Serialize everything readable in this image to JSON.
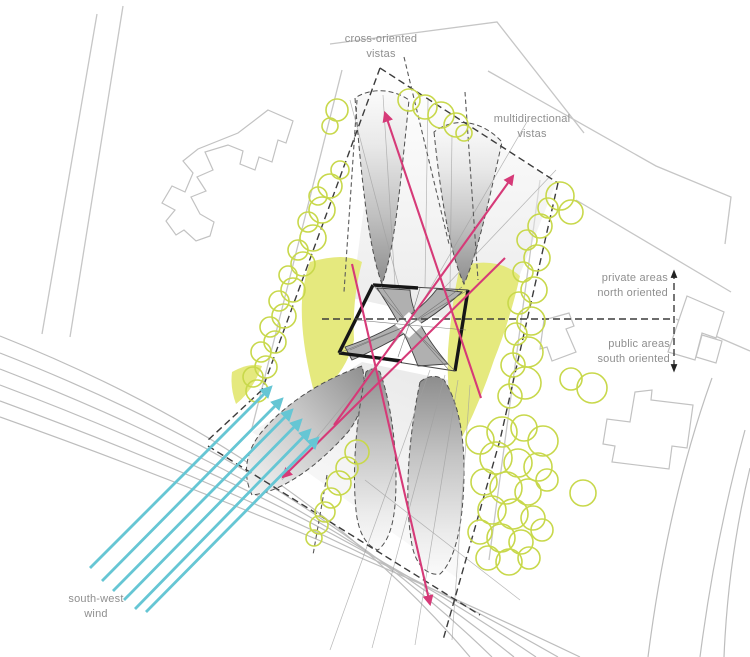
{
  "diagram": {
    "title": "site analysis diagram",
    "labels": {
      "cross_oriented": "cross-oriented\nvistas",
      "multidirectional": "multidirectional\nvistas",
      "private_areas": "private areas\nnorth oriented",
      "public_areas": "public areas\nsouth oriented",
      "wind": "south-west\nwind"
    },
    "legend_semantics": {
      "pink_arrows": "vista directions",
      "cyan_arrows": "south-west wind",
      "green_circles": "trees",
      "yellow_areas": "green areas",
      "gray_cones": "view cones"
    },
    "colors": {
      "vista_arrow": "#d63a78",
      "wind_arrow": "#66c6d4",
      "tree": "#c8d84b",
      "area_fill": "#e5e97e",
      "label_text": "#8f8f8f",
      "dashed_line": "#3c3c3c",
      "context_line": "#c6c6c6",
      "building_dark": "#161616"
    }
  }
}
